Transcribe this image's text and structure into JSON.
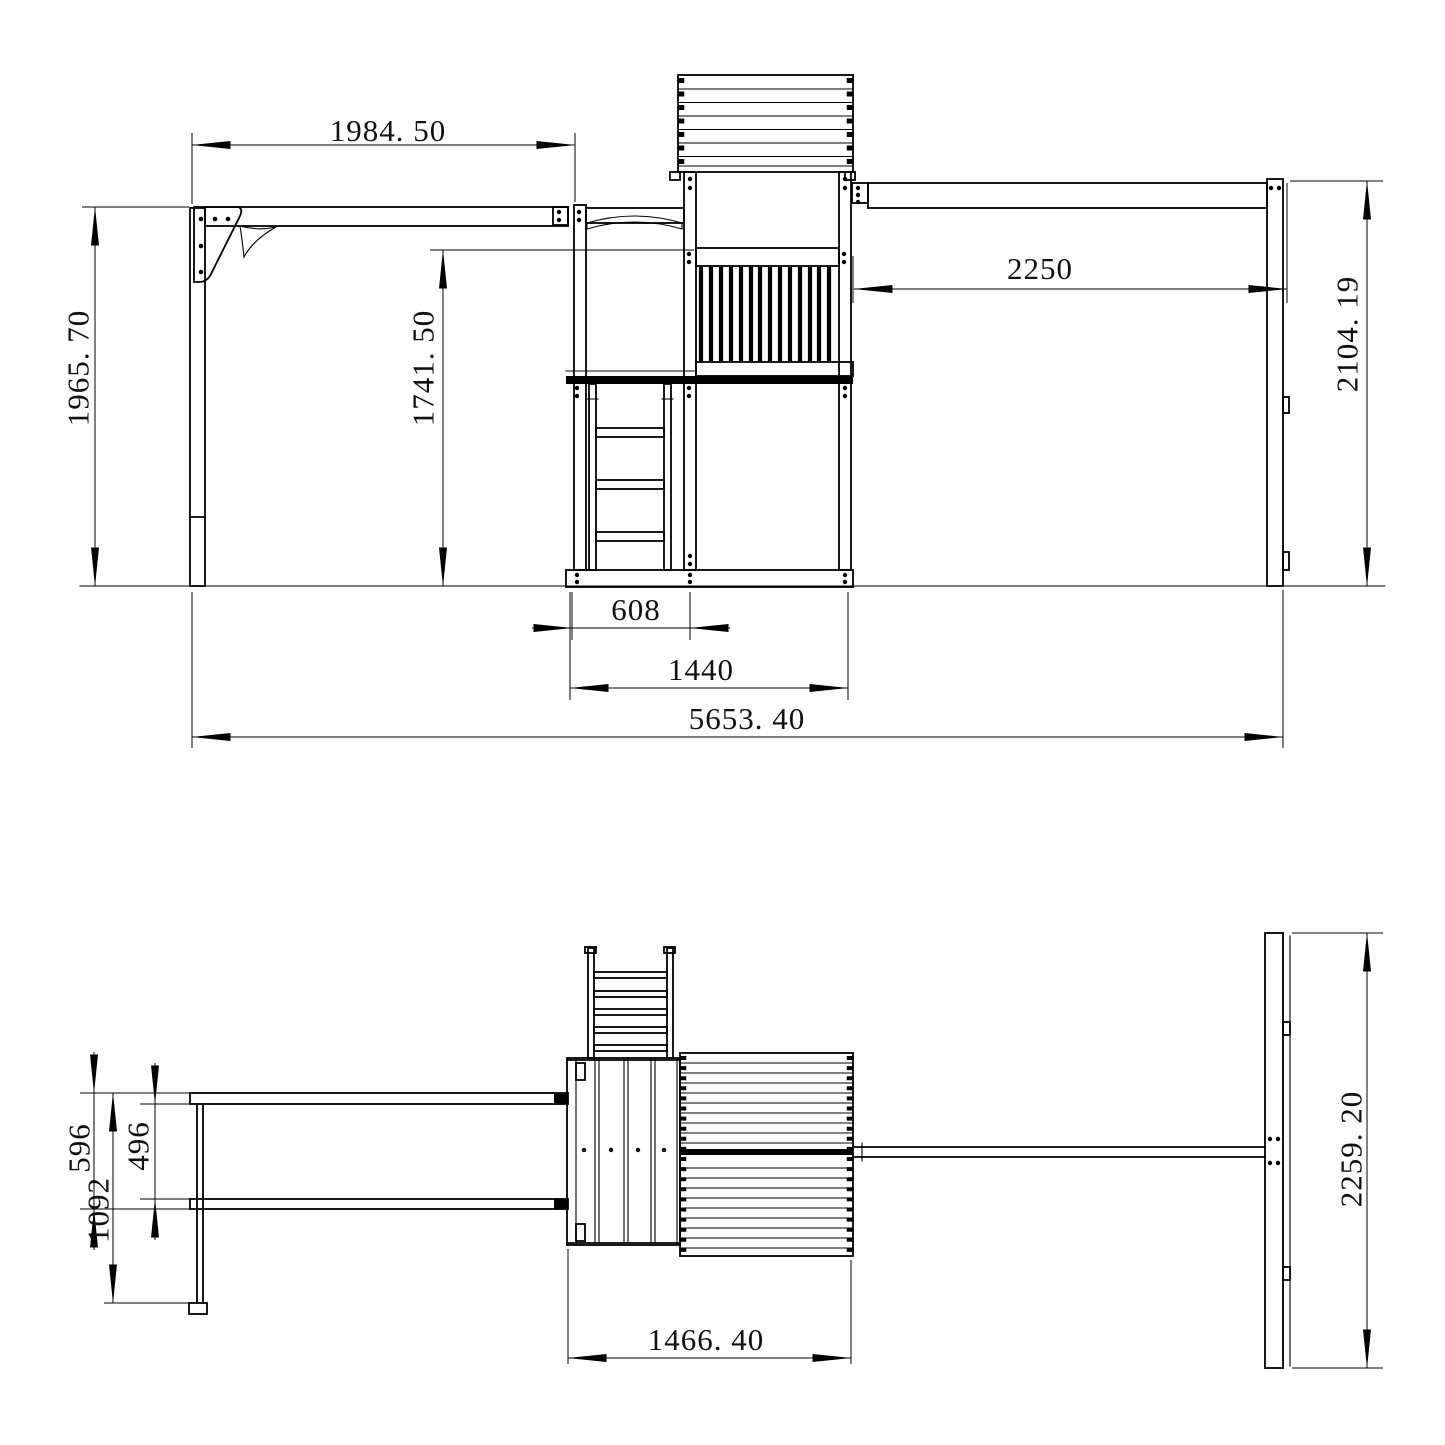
{
  "colors": {
    "line": "#000000",
    "background": "#ffffff",
    "text": "#111111"
  },
  "front_view": {
    "dimensions": {
      "swing_beam_left_span": "1984. 50",
      "left_post_height": "1965. 70",
      "platform_rail_height": "1741. 50",
      "swing_beam_right_span": "2250",
      "right_frame_height": "2104. 19",
      "ladder_bay_width": "608",
      "tower_base_width": "1440",
      "overall_length": "5653. 40"
    }
  },
  "top_view": {
    "dimensions": {
      "beam_spacing_outer": "596",
      "beam_spacing_inner": "496",
      "leg_crossbar_length": "1092",
      "right_frame_depth": "2259. 20",
      "tower_platform_depth": "1466. 40"
    }
  }
}
